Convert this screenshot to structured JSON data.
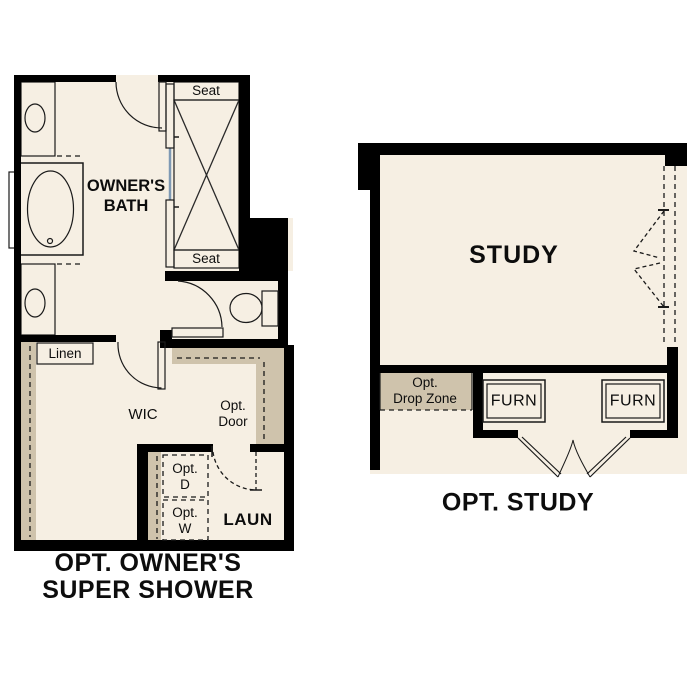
{
  "colors": {
    "wall": "#000000",
    "floor": "#f6efe3",
    "cabinet_tan": "#c7baa1",
    "shelf_tan": "#cfc3ac",
    "fixture_blue": "#abc9e9",
    "appliance_gray": "#e4e4e4",
    "label_text": "#0d0d0d"
  },
  "left_plan": {
    "caption_line1": "OPT. OWNER'S",
    "caption_line2": "SUPER SHOWER",
    "bath_label_line1": "OWNER'S",
    "bath_label_line2": "BATH",
    "seat_top": "Seat",
    "seat_bottom": "Seat",
    "linen": "Linen",
    "wic": "WIC",
    "opt_door_line1": "Opt.",
    "opt_door_line2": "Door",
    "opt_dryer_line1": "Opt.",
    "opt_dryer_line2": "D",
    "opt_washer_line1": "Opt.",
    "opt_washer_line2": "W",
    "laundry": "LAUN"
  },
  "right_plan": {
    "caption": "OPT. STUDY",
    "study": "STUDY",
    "drop_zone_line1": "Opt.",
    "drop_zone_line2": "Drop Zone",
    "furnace_left": "FURN",
    "furnace_right": "FURN"
  }
}
